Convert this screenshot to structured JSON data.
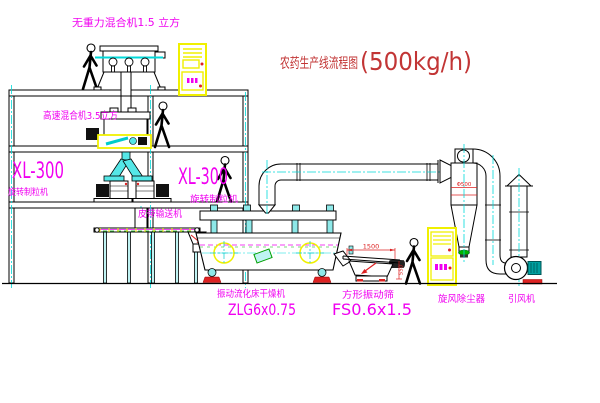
{
  "title": {
    "name_cn": "农药生产线流程图",
    "capacity": "(500kg/h)"
  },
  "equipment_labels": {
    "gravity_free_mixer": "无重力混合机1.5 立方",
    "high_speed_mixer": "高速混合机3.5立方",
    "granulator_left": {
      "model": "XL-300",
      "name": "旋转制粒机"
    },
    "granulator_right": {
      "model": "XL-300",
      "name": "旋转制粒机"
    },
    "belt_conveyor": "皮带输送机",
    "fluid_bed_dryer": {
      "name": "振动流化床干燥机",
      "model": "ZLG6x0.75"
    },
    "square_vibrating_sieve": {
      "name": "方形振动筛",
      "model": "FS0.6x1.5"
    },
    "cyclone_dust_collector": "旋风除尘器",
    "induced_draft_fan": "引风机"
  },
  "dimensions": {
    "sieve_length": "1500",
    "sieve_height": "550",
    "cyclone_note": "Φ500"
  },
  "colors": {
    "background": "#ffffff",
    "outline": "#000000",
    "label_magenta": "#f000f0",
    "title_red": "#c23535",
    "dimension_red": "#dd2222",
    "centerline_cyan": "#00d9d9",
    "pipe_fill_cyan": "#55e7e7",
    "cabinet_yellow": "#f0f000",
    "conveyor_green": "#00b400"
  }
}
